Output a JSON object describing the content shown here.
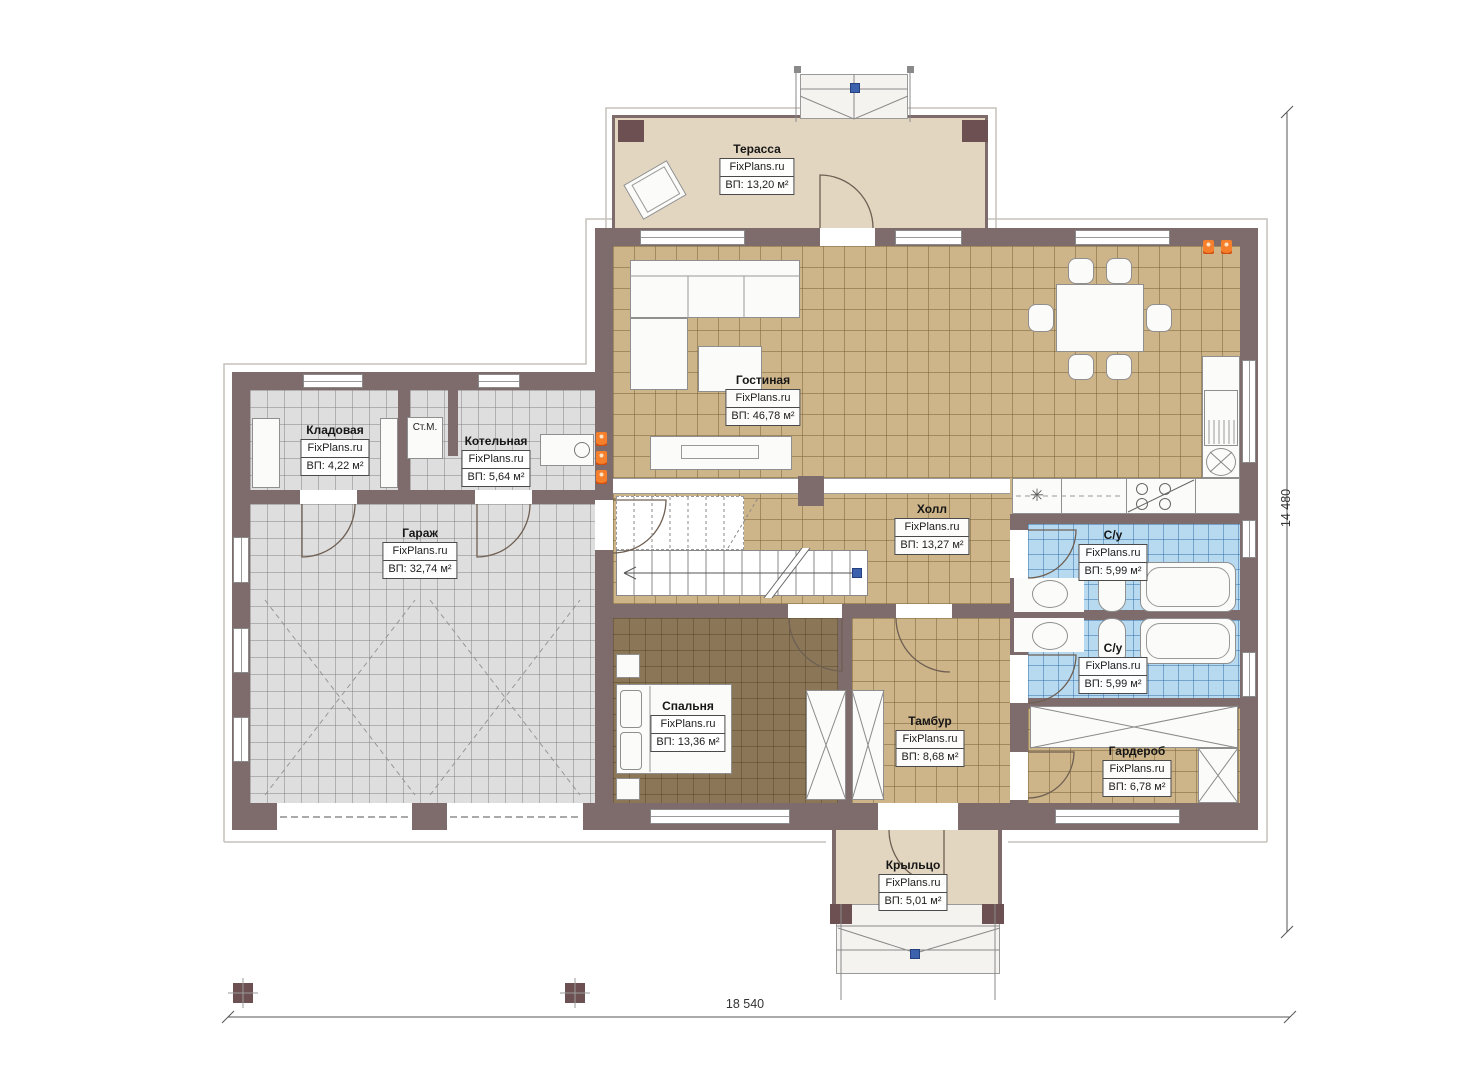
{
  "watermark": "FixPlans.ru",
  "rooms": {
    "terrace": {
      "name": "Терасса",
      "area": "ВП: 13,20 м²"
    },
    "living": {
      "name": "Гостиная",
      "area": "ВП: 46,78 м²"
    },
    "storage": {
      "name": "Кладовая",
      "area": "ВП: 4,22 м²"
    },
    "boiler": {
      "name": "Котельная",
      "area": "ВП: 5,64 м²"
    },
    "garage": {
      "name": "Гараж",
      "area": "ВП: 32,74 м²"
    },
    "hall": {
      "name": "Холл",
      "area": "ВП: 13,27 м²"
    },
    "bath1": {
      "name": "С/у",
      "area": "ВП: 5,99 м²"
    },
    "bath2": {
      "name": "С/у",
      "area": "ВП: 5,99 м²"
    },
    "bedroom": {
      "name": "Спальня",
      "area": "ВП: 13,36 м²"
    },
    "vestibule": {
      "name": "Тамбур",
      "area": "ВП: 8,68 м²"
    },
    "wardrobe": {
      "name": "Гардероб",
      "area": "ВП: 6,78 м²"
    },
    "porch": {
      "name": "Крыльцо",
      "area": "ВП: 5,01 м²"
    }
  },
  "annotations": {
    "washing_machine": "Ст.М."
  },
  "dimensions": {
    "overall_width": "18 540",
    "overall_height": "14 480"
  },
  "icons": {
    "fridge_snowflake": "✳"
  },
  "colors": {
    "wall": "#7e6c6d",
    "post": "#6d5152",
    "floor-tan": "#cdb489",
    "floor-gray": "#dedede",
    "floor-blue": "#b7daf0",
    "floor-beige": "#e3d6c1",
    "floor-bedroom": "#8b7758",
    "fixture": "#fbfbf9",
    "accent-orange": "#e8611c",
    "dot-blue": "#3c62ad"
  }
}
